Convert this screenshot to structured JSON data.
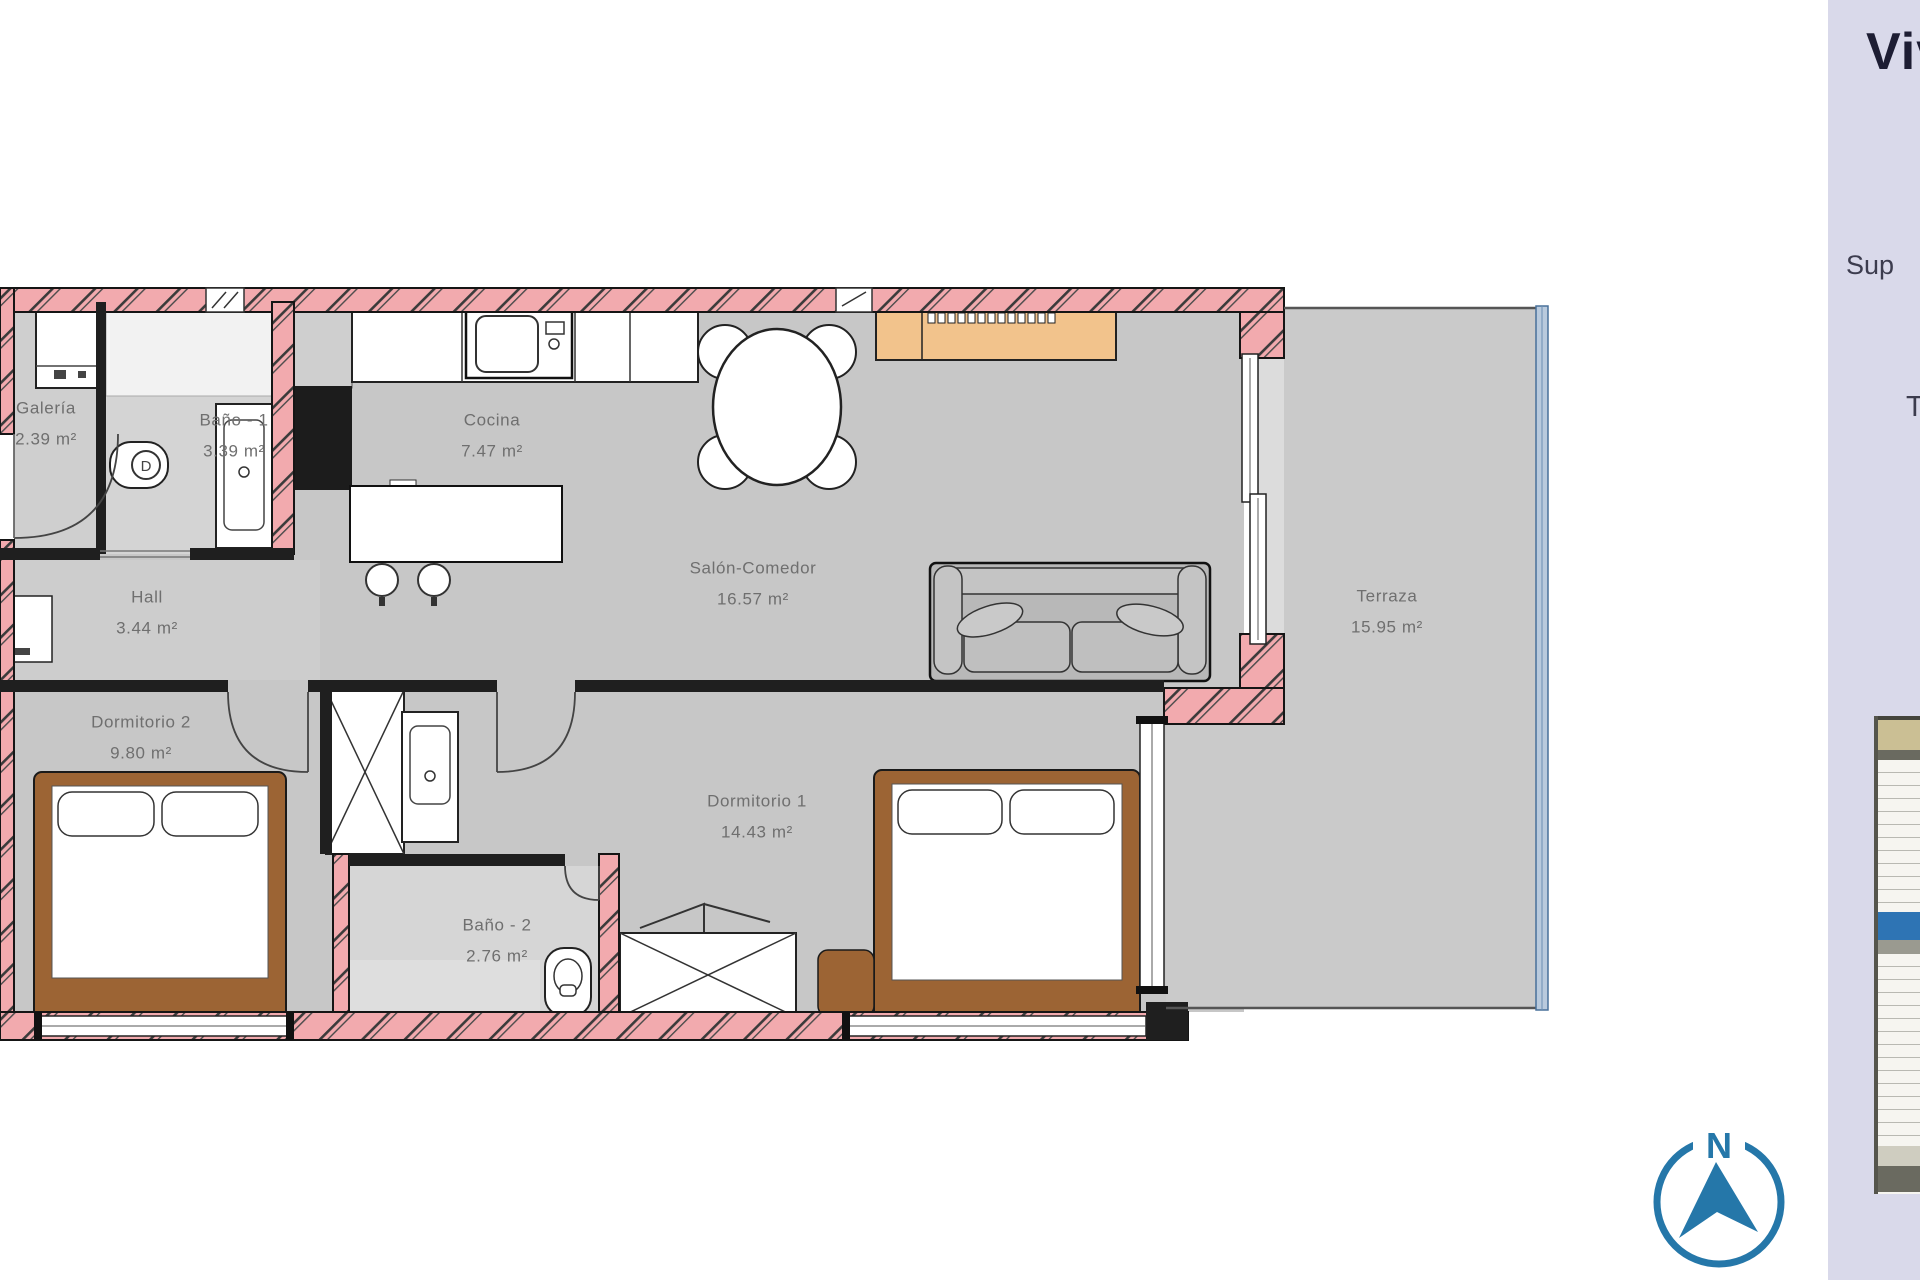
{
  "plan": {
    "rooms": [
      {
        "id": "galeria",
        "name": "Galería",
        "area": "2.39 m²"
      },
      {
        "id": "bano1",
        "name": "Baño - 1",
        "area": "3.39 m²"
      },
      {
        "id": "cocina",
        "name": "Cocina",
        "area": "7.47 m²"
      },
      {
        "id": "salon",
        "name": "Salón-Comedor",
        "area": "16.57 m²"
      },
      {
        "id": "hall",
        "name": "Hall",
        "area": "3.44 m²"
      },
      {
        "id": "dormitorio2",
        "name": "Dormitorio 2",
        "area": "9.80 m²"
      },
      {
        "id": "dormitorio1",
        "name": "Dormitorio 1",
        "area": "14.43 m²"
      },
      {
        "id": "bano2",
        "name": "Baño - 2",
        "area": "2.76 m²"
      },
      {
        "id": "terraza",
        "name": "Terraza",
        "area": "15.95 m²"
      }
    ],
    "fixture_mark": "D",
    "compass": {
      "north_label": "N"
    }
  },
  "side_panel": {
    "title_fragment": "Viv",
    "superficie_fragment": "Sup",
    "terraza_fragment": "T"
  },
  "colors": {
    "wall_pink": "#f2aaae",
    "floor_gray": "#c7c7c7",
    "terrace_gray": "#cacaca",
    "accent_blue": "#2577a9",
    "panel_lavender": "#d9d9ea",
    "wood_brown": "#9c6434",
    "sideboard_tan": "#f2c38c",
    "keyplan_blue": "#2e74b4"
  }
}
